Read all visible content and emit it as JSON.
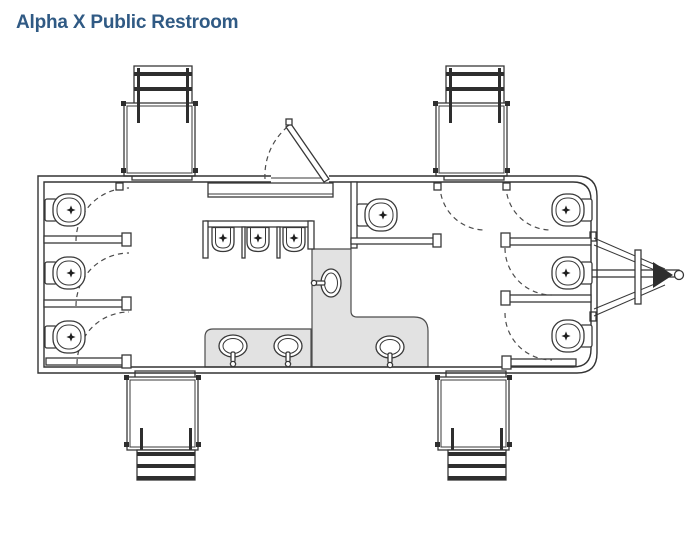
{
  "header": {
    "title": "Alpha X Public Restroom",
    "title_color": "#305a84"
  },
  "diagram": {
    "type": "floor-plan",
    "subject": "Alpha X public restroom trailer, top-down plan view",
    "line_color": "#383838",
    "counter_fill": "#e2e2e2",
    "fixtures": {
      "toilets": 7,
      "urinals": 3,
      "sinks": 4,
      "sink_counters": 2,
      "staircases": 4,
      "entry_doors": 1,
      "interior_door_swings": 7,
      "tongue_hitch": 1
    },
    "rooms": [
      {
        "name": "left-restroom",
        "toilets": 3,
        "urinals": 3,
        "sinks": 2
      },
      {
        "name": "right-restroom",
        "toilets": 4,
        "sinks": 2
      }
    ]
  }
}
